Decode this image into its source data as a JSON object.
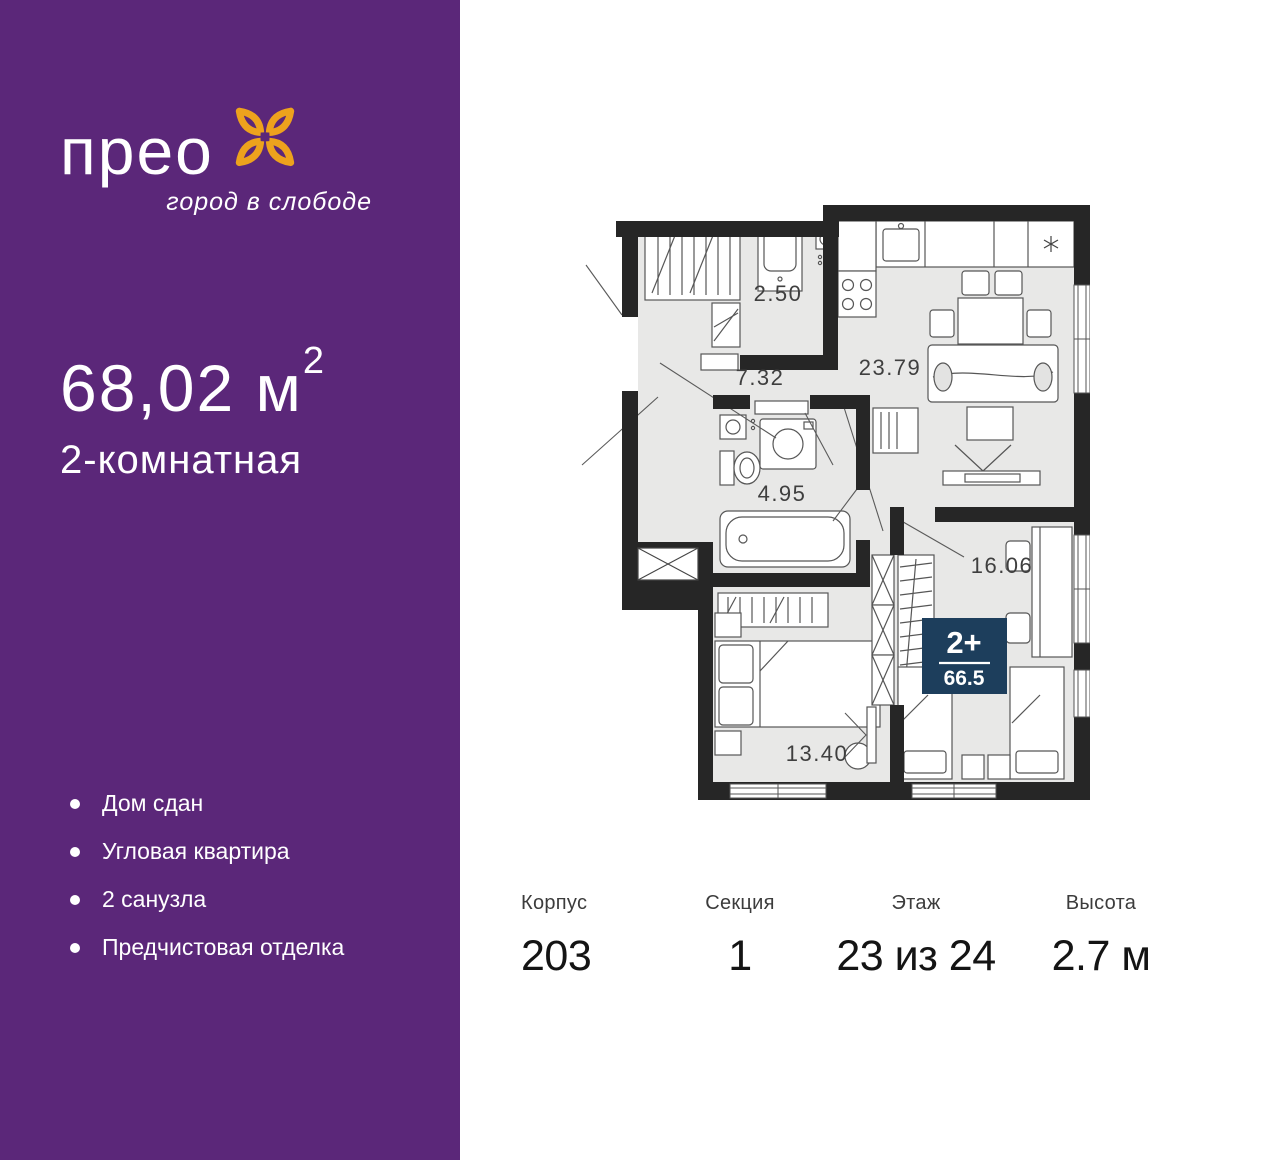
{
  "logo": {
    "name": "прео",
    "tagline": "город в слободе"
  },
  "apartment": {
    "area_value": "68,02 м",
    "area_sup": "2",
    "type": "2-комнатная"
  },
  "sidebar_features": [
    "Дом сдан",
    "Угловая квартира",
    "2 санузла",
    "Предчистовая отделка"
  ],
  "plan": {
    "rooms": [
      {
        "id": "utility",
        "area": "2.50"
      },
      {
        "id": "hallway",
        "area": "7.32"
      },
      {
        "id": "kitchen-living",
        "area": "23.79"
      },
      {
        "id": "bathroom",
        "area": "4.95"
      },
      {
        "id": "bedroom-right",
        "area": "16.06"
      },
      {
        "id": "bedroom-left",
        "area": "13.40"
      }
    ],
    "badge": {
      "rooms_label": "2+",
      "total_area": "66.5"
    }
  },
  "info": {
    "columns": [
      {
        "label": "Корпус",
        "value": "203"
      },
      {
        "label": "Секция",
        "value": "1"
      },
      {
        "label": "Этаж",
        "value": "23 из 24"
      },
      {
        "label": "Высота",
        "value": "2.7 м"
      }
    ]
  },
  "colors": {
    "purple": "#5b2779",
    "orange": "#eda21d",
    "badge_navy": "#1d3e5c",
    "wall": "#262626",
    "floor": "#e8e8e7"
  }
}
